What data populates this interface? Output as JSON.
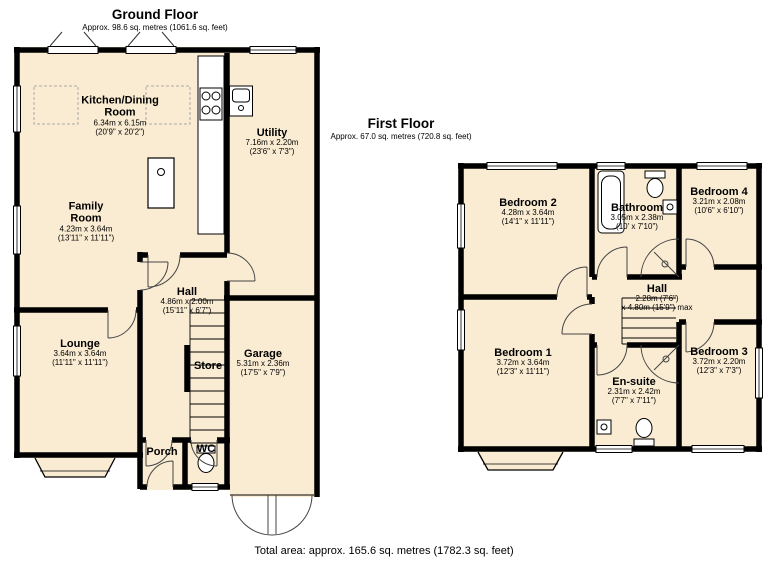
{
  "page": {
    "total_area": "Total area: approx. 165.6 sq. metres (1782.3 sq. feet)"
  },
  "colors": {
    "room_fill": "#faecd2",
    "wall": "#000000",
    "thin_line": "#333333"
  },
  "floors": {
    "ground": {
      "title": "Ground Floor",
      "subtitle": "Approx. 98.6 sq. metres (1061.6 sq. feet)",
      "rooms": {
        "kitchen_dining": {
          "name": "Kitchen/Dining Room",
          "metric": "6.34m x 6.15m",
          "imperial": "(20'9\" x 20'2\")"
        },
        "utility": {
          "name": "Utility",
          "metric": "7.16m x 2.20m",
          "imperial": "(23'6\" x 7'3\")"
        },
        "family_room": {
          "name": "Family Room",
          "metric": "4.23m x 3.64m",
          "imperial": "(13'11\" x 11'11\")"
        },
        "hall": {
          "name": "Hall",
          "metric": "4.86m x 2.00m",
          "imperial": "(15'11\" x 6'7\")"
        },
        "lounge": {
          "name": "Lounge",
          "metric": "3.64m x 3.64m",
          "imperial": "(11'11\" x 11'11\")"
        },
        "store": {
          "name": "Store"
        },
        "garage": {
          "name": "Garage",
          "metric": "5.31m x 2.36m",
          "imperial": "(17'5\" x 7'9\")"
        },
        "porch": {
          "name": "Porch"
        },
        "wc": {
          "name": "WC"
        }
      }
    },
    "first": {
      "title": "First Floor",
      "subtitle": "Approx. 67.0 sq. metres (720.8 sq. feet)",
      "rooms": {
        "bedroom2": {
          "name": "Bedroom 2",
          "metric": "4.28m x 3.64m",
          "imperial": "(14'1\" x 11'11\")"
        },
        "bathroom": {
          "name": "Bathroom",
          "metric": "3.05m x 2.38m",
          "imperial": "(10' x 7'10\")"
        },
        "bedroom4": {
          "name": "Bedroom 4",
          "metric": "3.21m x 2.08m",
          "imperial": "(10'6\" x 6'10\")"
        },
        "hall": {
          "name": "Hall",
          "metric": "2.28m (7'6\")",
          "imperial": "x 4.80m (15'9\") max"
        },
        "bedroom1": {
          "name": "Bedroom 1",
          "metric": "3.72m x 3.64m",
          "imperial": "(12'3\" x 11'11\")"
        },
        "ensuite": {
          "name": "En-suite",
          "metric": "2.31m x 2.42m",
          "imperial": "(7'7\" x 7'11\")"
        },
        "bedroom3": {
          "name": "Bedroom 3",
          "metric": "3.72m x 2.20m",
          "imperial": "(12'3\" x 7'3\")"
        }
      }
    }
  }
}
